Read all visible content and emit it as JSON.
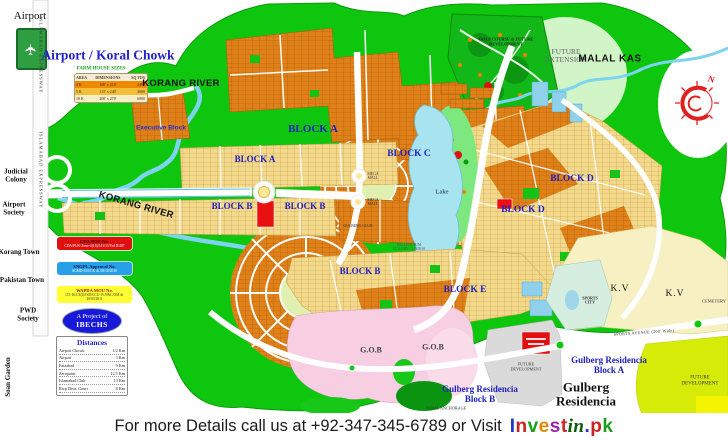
{
  "banner": {
    "text": "For more Details call us at +92-347-345-6789 or Visit",
    "logo": {
      "invest": "Invest",
      "in": "in",
      "pk": ".pk"
    },
    "logo_colors": [
      "#2233cc",
      "#cc2222",
      "#18a018",
      "#dd8800",
      "#9922aa",
      "#cc2222"
    ]
  },
  "top_left": {
    "airport_label": "Airport",
    "airport_icon": "airplane-icon",
    "title": "Airport / Koral Chowk",
    "farm_table": {
      "title": "FARM HOUSE SIZES",
      "headers": [
        "AREA",
        "DIMENSIONS",
        "SQ YDS"
      ],
      "rows": [
        [
          "4 K",
          "100' x 210'",
          "2400"
        ],
        [
          "5 K",
          "115' x 240'",
          "3000"
        ],
        [
          "10 K",
          "200' x 270'",
          "6000"
        ]
      ]
    }
  },
  "roads": {
    "expressway": "ISLAMABAD EXPRESSWAY",
    "sports_avenue": "SPORTS AVENUE (200' Wide)"
  },
  "waterways": {
    "korang_top": "KORANG RIVER",
    "korang_lower": "KORANG RIVER",
    "malal_kas": "MALAL KAS",
    "lake": "Lake"
  },
  "left_side": {
    "judicial_colony": "Judicial Colony",
    "airport_society": "Airport Society",
    "korang_town": "Korang Town",
    "pakistan_town": "Pakistan Town",
    "pwd_society": "PWD Society",
    "soan_garden": "Soan Garden"
  },
  "blocks": {
    "executive": "Executive Block",
    "a1": "BLOCK A",
    "a2": "BLOCK A",
    "b1": "BLOCK B",
    "b2": "BLOCK B",
    "b3": "BLOCK B",
    "c": "BLOCK C",
    "d1": "BLOCK D",
    "d2": "BLOCK D",
    "e": "BLOCK E",
    "kv1": "K.V",
    "kv2": "K.V"
  },
  "areas": {
    "golf": "GOLF COURSE & FUTURE DEVELOPMENT",
    "future_extension": "FUTURE EXTENSION",
    "gob1": "G.O.B",
    "gob2": "G.O.B",
    "sports_city": "SPORTS CITY",
    "future_dev_center": "FUTURE DEVELOPMENT",
    "future_dev_right": "FUTURE DEVELOPMENT",
    "cemetery": "CEMETERY",
    "naval_anchorage": "NAVAL ANCHORAGE",
    "gulberg_residencia": "Gulberg Residencia",
    "gr_block_a": "Gulberg Residencia Block A",
    "gr_block_b": "Gulberg Residencia Block B",
    "mega_mall_1": "MEGA MALL",
    "mega_mall_2": "MEGA MALL",
    "gulberg_club": "GULBERG CLUB",
    "luxury_condos": "MILLENNIUM LUXURY CONDOS"
  },
  "approvals": [
    {
      "title": "CDA NOC No.",
      "detail": "CDA/PLW-Zone-4(16)/141/13/Vol-II/487"
    },
    {
      "title": "SNGPL Approval No.",
      "detail": "SGMD-555/CK dt. 08/10/2010"
    },
    {
      "title": "WAPDA MOU No.",
      "detail": "115-16/CE(I)/ISD/CCU-IV/P&C/OM dt. 30/03/2011"
    }
  ],
  "project": {
    "line1": "A Project of",
    "line2": "IBECHS"
  },
  "distances": {
    "title": "Distances",
    "rows": [
      [
        "Airport Chowk",
        "1/2 Km"
      ],
      [
        "Airport",
        "3 Km"
      ],
      [
        "Faizabad",
        "9 Km"
      ],
      [
        "Zeropoint",
        "12.5 Km"
      ],
      [
        "Islamabad Club",
        "13 Km"
      ],
      [
        "Rwp Distt. Court",
        "8 Km"
      ]
    ]
  },
  "compass": {
    "north": "N"
  },
  "colors": {
    "map_green": "#0fc60f",
    "block_orange": "#e08018",
    "block_tan": "#f2d98c",
    "water_blue": "#7cd4ee",
    "gob_pink": "#f8cfe2",
    "highlight_red": "#e01010",
    "label_blue": "#2020c0",
    "future_yellow": "#d6ec08"
  }
}
